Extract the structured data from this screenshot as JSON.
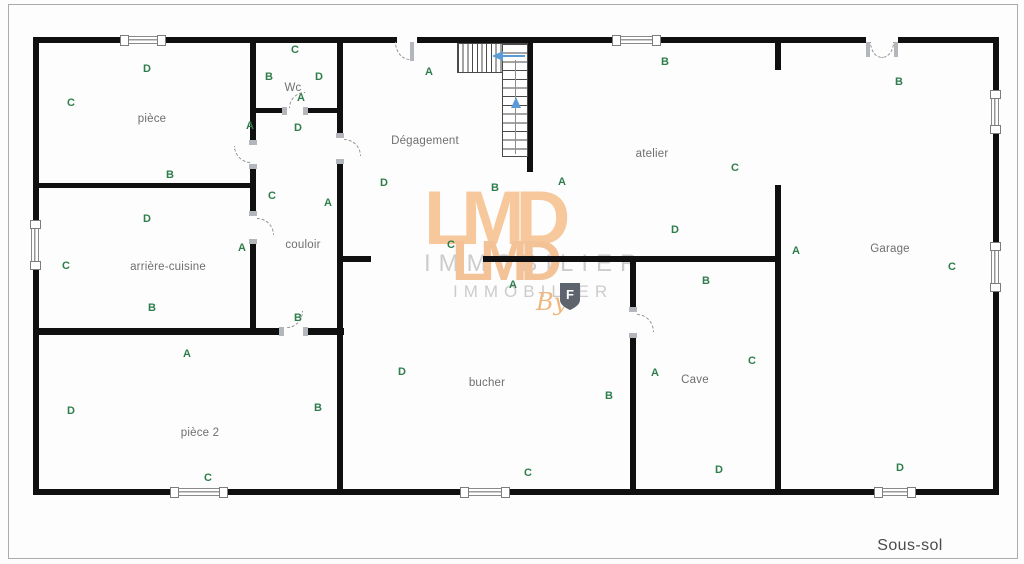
{
  "frame": {
    "floor_label": "Sous-sol"
  },
  "colors": {
    "wall_black": "#101010",
    "marker_green": "#2e7d4b",
    "room_label_gray": "#6f6f6f",
    "stair_arrow_blue": "#5b9bd5",
    "watermark_orange": "#f6c89c",
    "watermark_gray": "#cccccc"
  },
  "watermark": {
    "brand_large": "LMD",
    "subtitle_large": "IMMOBILIER",
    "brand_small": "LMD",
    "subtitle_small": "IMMOBILIER",
    "by_text": "By",
    "shield_letter": "F"
  },
  "rooms": [
    {
      "id": "piece",
      "label": "pièce",
      "label_x": 152,
      "label_y": 119,
      "markers": [
        {
          "letter": "D",
          "x": 147,
          "y": 69
        },
        {
          "letter": "C",
          "x": 71,
          "y": 103
        },
        {
          "letter": "A",
          "x": 250,
          "y": 126
        },
        {
          "letter": "B",
          "x": 170,
          "y": 175
        }
      ]
    },
    {
      "id": "wc",
      "label": "Wc",
      "label_x": 293,
      "label_y": 88,
      "markers": [
        {
          "letter": "C",
          "x": 295,
          "y": 50
        },
        {
          "letter": "B",
          "x": 269,
          "y": 77
        },
        {
          "letter": "D",
          "x": 319,
          "y": 77
        },
        {
          "letter": "A",
          "x": 301,
          "y": 98
        }
      ]
    },
    {
      "id": "couloir",
      "label": "couloir",
      "label_x": 303,
      "label_y": 245,
      "markers": [
        {
          "letter": "D",
          "x": 298,
          "y": 128
        },
        {
          "letter": "C",
          "x": 272,
          "y": 196
        },
        {
          "letter": "A",
          "x": 328,
          "y": 203
        },
        {
          "letter": "B",
          "x": 298,
          "y": 318
        }
      ]
    },
    {
      "id": "arriere-cuisine",
      "label": "arrière-cuisine",
      "label_x": 168,
      "label_y": 267,
      "markers": [
        {
          "letter": "D",
          "x": 147,
          "y": 219
        },
        {
          "letter": "C",
          "x": 66,
          "y": 266
        },
        {
          "letter": "A",
          "x": 242,
          "y": 248
        },
        {
          "letter": "B",
          "x": 152,
          "y": 308
        }
      ]
    },
    {
      "id": "piece-2",
      "label": "pièce 2",
      "label_x": 200,
      "label_y": 433,
      "markers": [
        {
          "letter": "A",
          "x": 187,
          "y": 354
        },
        {
          "letter": "D",
          "x": 71,
          "y": 411
        },
        {
          "letter": "B",
          "x": 318,
          "y": 408
        },
        {
          "letter": "C",
          "x": 208,
          "y": 478
        }
      ]
    },
    {
      "id": "degagement",
      "label": "Dégagement",
      "label_x": 425,
      "label_y": 141,
      "markers": [
        {
          "letter": "A",
          "x": 429,
          "y": 72
        },
        {
          "letter": "D",
          "x": 384,
          "y": 183
        },
        {
          "letter": "C",
          "x": 451,
          "y": 245
        },
        {
          "letter": "B",
          "x": 495,
          "y": 188
        }
      ]
    },
    {
      "id": "atelier",
      "label": "atelier",
      "label_x": 652,
      "label_y": 154,
      "markers": [
        {
          "letter": "B",
          "x": 665,
          "y": 62
        },
        {
          "letter": "A",
          "x": 562,
          "y": 182
        },
        {
          "letter": "C",
          "x": 735,
          "y": 168
        },
        {
          "letter": "D",
          "x": 675,
          "y": 230
        }
      ]
    },
    {
      "id": "garage",
      "label": "Garage",
      "label_x": 890,
      "label_y": 249,
      "markers": [
        {
          "letter": "B",
          "x": 899,
          "y": 82
        },
        {
          "letter": "A",
          "x": 796,
          "y": 251
        },
        {
          "letter": "C",
          "x": 952,
          "y": 267
        },
        {
          "letter": "D",
          "x": 900,
          "y": 468
        }
      ]
    },
    {
      "id": "bucher",
      "label": "bucher",
      "label_x": 487,
      "label_y": 383,
      "markers": [
        {
          "letter": "A",
          "x": 513,
          "y": 285
        },
        {
          "letter": "D",
          "x": 402,
          "y": 372
        },
        {
          "letter": "B",
          "x": 609,
          "y": 396
        },
        {
          "letter": "C",
          "x": 528,
          "y": 473
        }
      ]
    },
    {
      "id": "cave",
      "label": "Cave",
      "label_x": 695,
      "label_y": 380,
      "markers": [
        {
          "letter": "B",
          "x": 706,
          "y": 281
        },
        {
          "letter": "C",
          "x": 752,
          "y": 361
        },
        {
          "letter": "A",
          "x": 655,
          "y": 373
        },
        {
          "letter": "D",
          "x": 719,
          "y": 470
        }
      ]
    }
  ]
}
